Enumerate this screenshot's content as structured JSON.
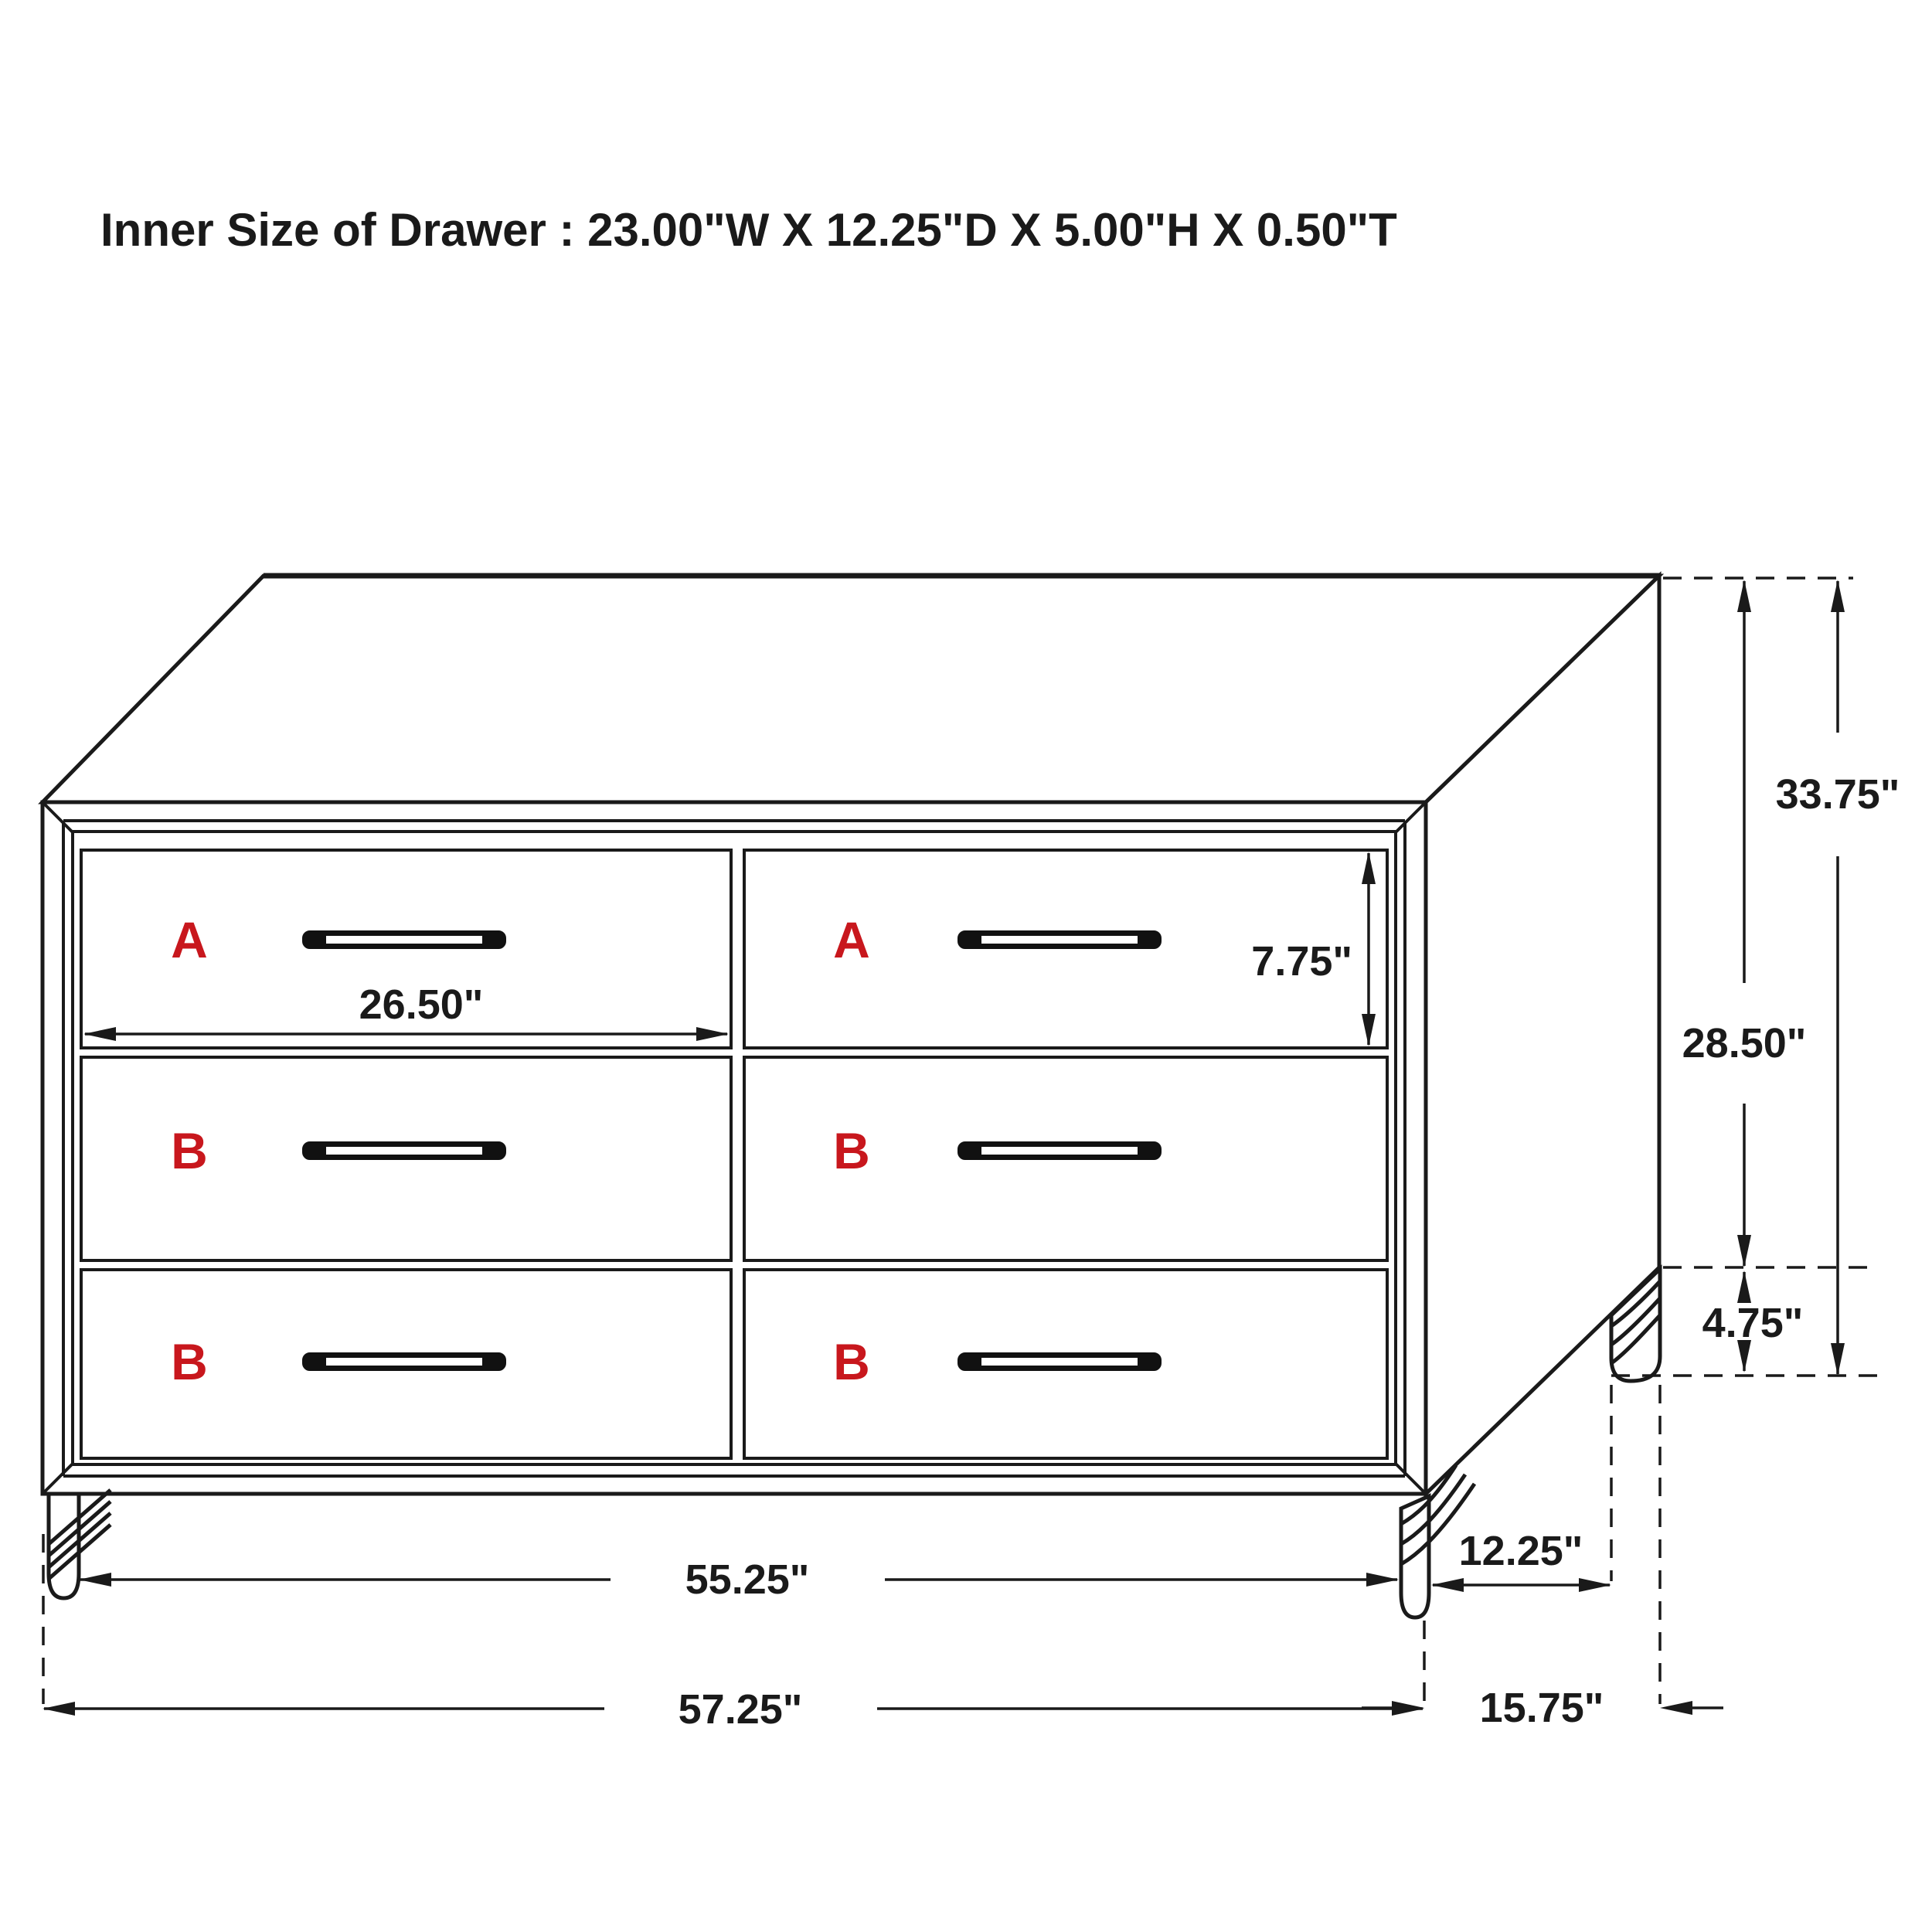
{
  "title": {
    "text": "Inner Size of Drawer : 23.00\"W X 12.25\"D X 5.00\"H X 0.50\"T"
  },
  "colors": {
    "line": "#1a1a1a",
    "label_red": "#c8171d",
    "background": "#ffffff"
  },
  "drawer_labels": {
    "top_left": "A",
    "top_right": "A",
    "middle_left": "B",
    "middle_right": "B",
    "bottom_left": "B",
    "bottom_right": "B"
  },
  "dimensions": {
    "overall_height": "33.75\"",
    "body_height": "28.50\"",
    "leg_height": "4.75\"",
    "drawer_front_height": "7.75\"",
    "drawer_front_width": "26.50\"",
    "front_leg_span_width": "55.25\"",
    "side_leg_span_depth": "12.25\"",
    "overall_width": "57.25\"",
    "overall_depth": "15.75\""
  }
}
